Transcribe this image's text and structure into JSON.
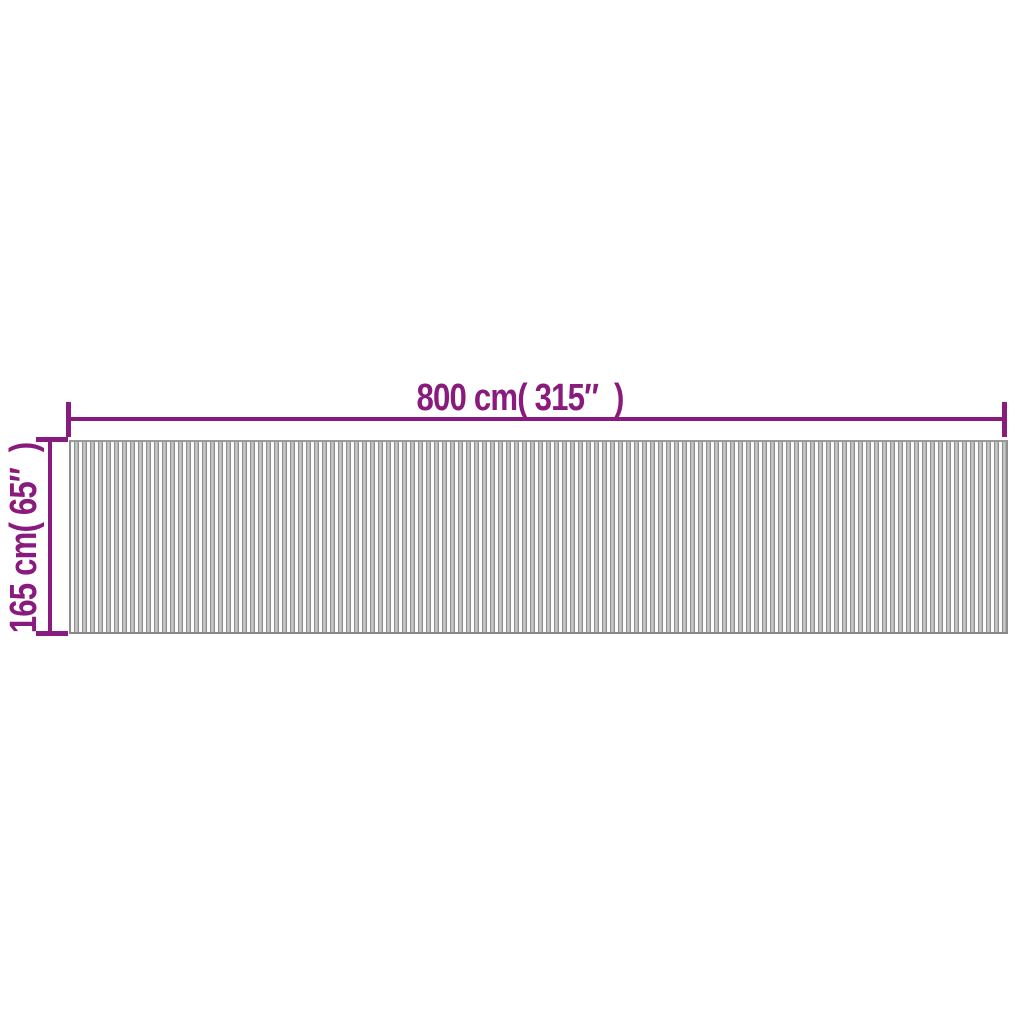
{
  "diagram": {
    "kind": "product-dimension-diagram",
    "width_label": "800 cm( 315″  )",
    "height_label": "165 cm( 65″  )",
    "colors": {
      "dimension_annotation": "#8a1b7e",
      "background": "#ffffff",
      "slat_white": "#ffffff",
      "slat_gray": "#bdbdbd",
      "slat_edge_line": "#8f8f8f"
    }
  }
}
